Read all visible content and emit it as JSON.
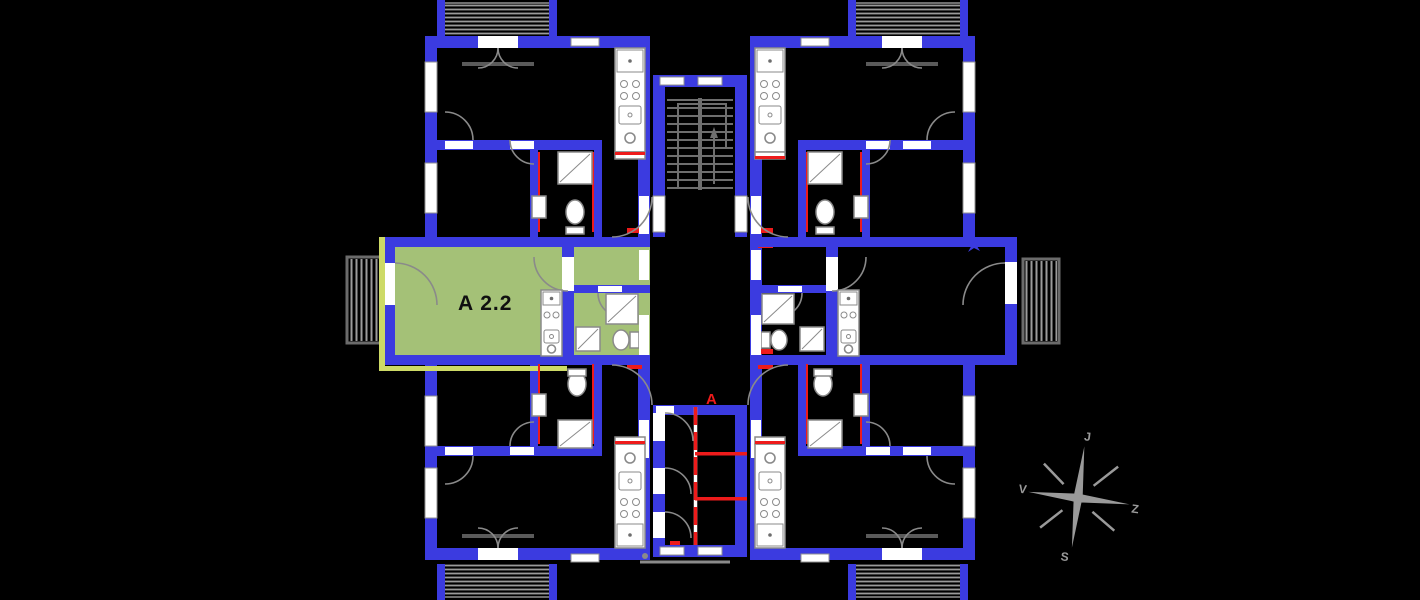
{
  "plan": {
    "unit_label": "A 2.2",
    "section_marker": "A"
  },
  "compass": {
    "top": "J",
    "right": "Z",
    "bottom": "S",
    "left": "V"
  },
  "colors": {
    "background": "#000000",
    "wall": "#3b3be0",
    "green": "#a4c177",
    "edge": "#cdda66",
    "red": "#ee1b1b",
    "stripe": "#9b9b9b",
    "fixture": "#8a8a8a",
    "compass": "#9a9a9a"
  }
}
